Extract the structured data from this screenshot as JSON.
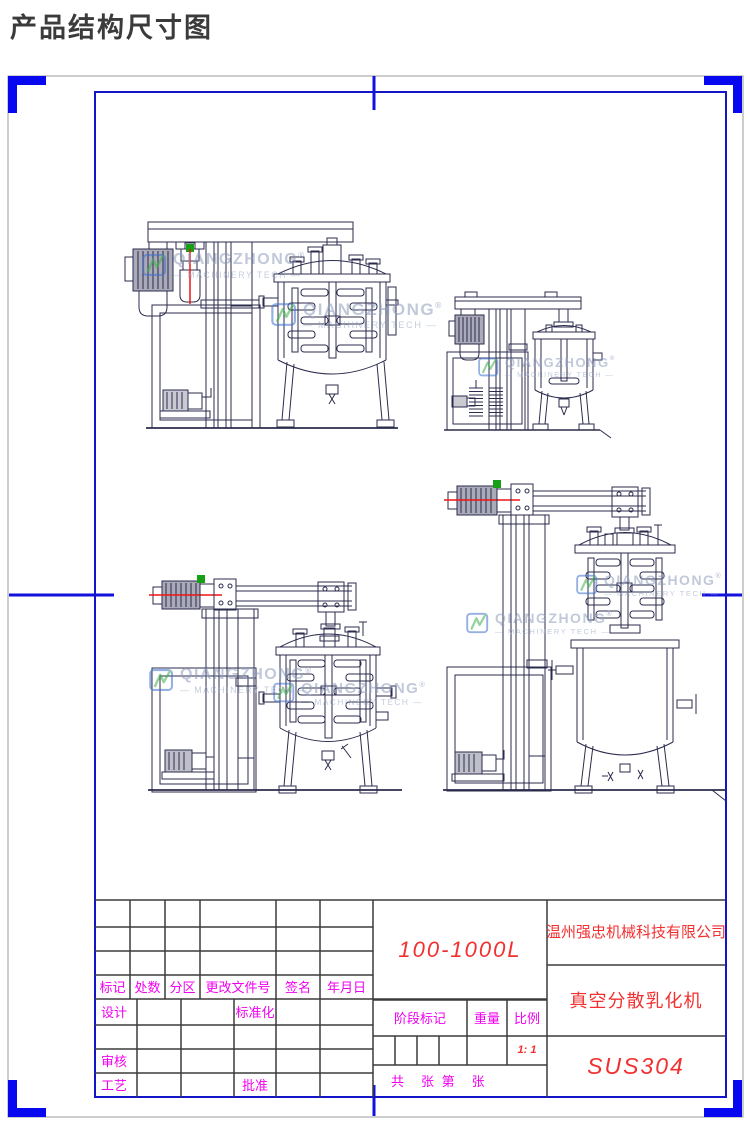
{
  "page_title": "产品结构尺寸图",
  "watermark": {
    "brand": "QIANGZHONG",
    "reg": "®",
    "tagline": "— MACHINERY TECH —"
  },
  "title_block": {
    "revision_headers": [
      "标记",
      "处数",
      "分区",
      "更改文件号",
      "签名",
      "年月日"
    ],
    "design": "设计",
    "standardize": "标准化",
    "audit": "审核",
    "process": "工艺",
    "approve": "批准",
    "model_range": "100-1000L",
    "stage_mark": "阶段标记",
    "weight": "重量",
    "scale": "比例",
    "scale_value": "1: 1",
    "sheet_info": "共　张 第　张",
    "company": "温州强忠机械科技有限公司",
    "product": "真空分散乳化机",
    "material": "SUS304"
  },
  "colors": {
    "frame_blue": "#1414c8",
    "corner_mark_blue": "#0808f0",
    "drawing_line_navy": "#2b2b4d",
    "label_magenta": "#f000f0",
    "value_red": "#f23030",
    "accent_red": "#f01414",
    "accent_green": "#16a016",
    "watermark_blue": "#4070cc",
    "watermark_green": "#3db24b",
    "watermark_text": "#8e9cbc"
  }
}
